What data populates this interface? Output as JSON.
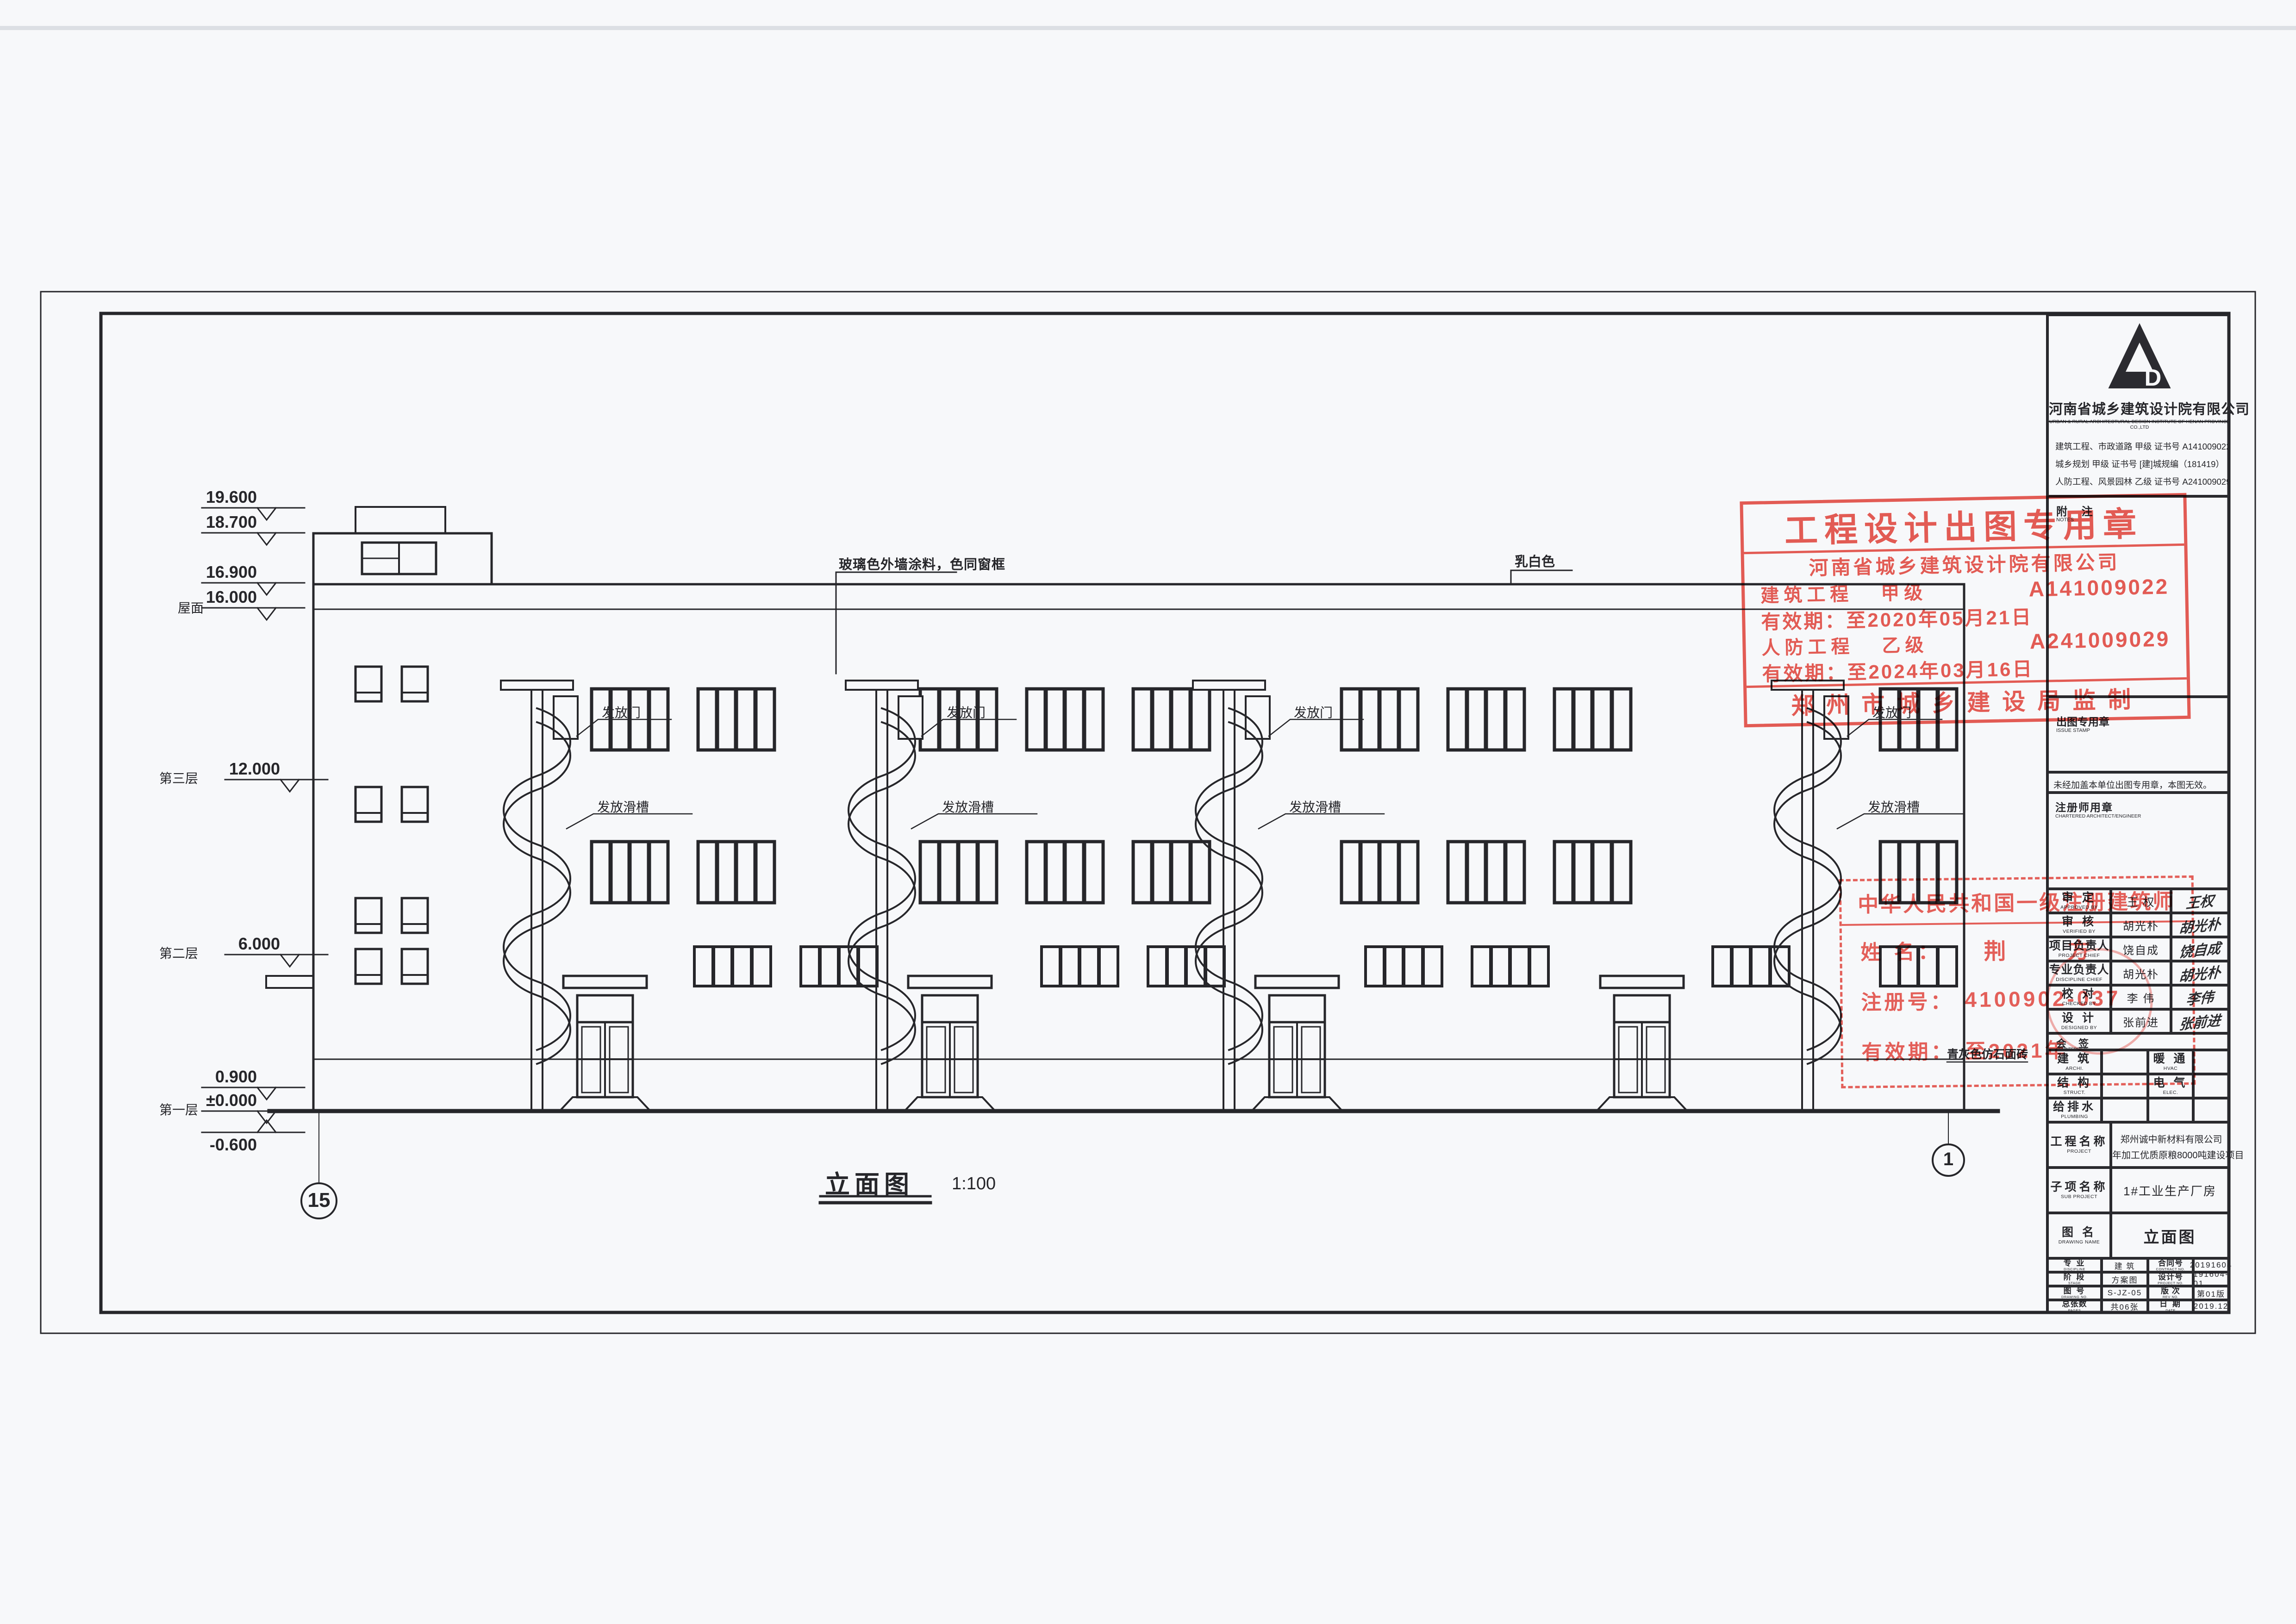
{
  "drawing": {
    "title": "立面图",
    "scale": "1:100",
    "annotations": {
      "wall_paint": "玻璃色外墙涂料，色同窗框",
      "parapet_color": "乳白色",
      "plinth": "青灰色仿石面砖",
      "chute_door": "发放门",
      "chute": "发放滑槽"
    },
    "elevations": [
      {
        "v": "19.600"
      },
      {
        "v": "18.700"
      },
      {
        "v": "16.900"
      },
      {
        "v": "16.000"
      },
      {
        "v": "12.000"
      },
      {
        "v": "6.000"
      },
      {
        "v": "0.900"
      },
      {
        "v": "±0.000"
      },
      {
        "v": "-0.600"
      }
    ],
    "floors": {
      "roof": "屋面",
      "f3": "第三层",
      "f2": "第二层",
      "f1": "第一层"
    },
    "axes": {
      "left": "15",
      "right": "1"
    }
  },
  "tb": {
    "company": {
      "name": "河南省城乡建筑设计院有限公司",
      "en": "URBAN & RURAL ARCHITECTURAL DESIGN INSTITUTE OF HENAN PROVINCE CO.,LTD",
      "cert1": "建筑工程、市政道路  甲级 证书号 A141009022",
      "cert2": "城乡规划  甲级  证书号 [建]城规编（181419）",
      "cert3": "人防工程、风景园林  乙级 证书号 A241009029",
      "logo_d": "D"
    },
    "notes": "附  注",
    "notes_en": "NOTES",
    "issue": "出图专用章",
    "issue_en": "ISSUE STAMP",
    "valid_note": "未经加盖本单位出图专用章，本图无效。",
    "chartered": "注册师用章",
    "chartered_en": "CHARTERED ARCHITECT/ENGINEER",
    "sig": [
      {
        "l": "审  定",
        "e": "APPROVED BY",
        "n": "王  权",
        "s": "王权"
      },
      {
        "l": "审  核",
        "e": "VERIFIED BY",
        "n": "胡光朴",
        "s": "胡光朴"
      },
      {
        "l": "项目负责人",
        "e": "PROJECT CHIEF",
        "n": "饶自成",
        "s": "饶自成"
      },
      {
        "l": "专业负责人",
        "e": "DISCIPLINE CHIEF",
        "n": "胡光朴",
        "s": "胡光朴"
      },
      {
        "l": "校  对",
        "e": "CHECKED BY",
        "n": "李  伟",
        "s": "李伟"
      },
      {
        "l": "设  计",
        "e": "DESIGNED BY",
        "n": "张前进",
        "s": "张前进"
      }
    ],
    "cs": {
      "l": "会  签",
      "e": "COUNTERSIGN"
    },
    "d1": {
      "l": "建  筑",
      "e": "ARCHI."
    },
    "d2": {
      "l": "暖  通",
      "e": "HVAC"
    },
    "d3": {
      "l": "结  构",
      "e": "STRUCT."
    },
    "d4": {
      "l": "电  气",
      "e": "ELEC."
    },
    "d5": {
      "l": "给排水",
      "e": "PLUMBING"
    },
    "proj": {
      "l": "工程名称",
      "e": "PROJECT",
      "v1": "郑州诚中新材料有限公司",
      "v2": "年加工优质原粮8000吨建设项目"
    },
    "sub": {
      "l": "子项名称",
      "e": "SUB PROJECT",
      "v": "1#工业生产厂房"
    },
    "dn": {
      "l": "图  名",
      "e": "DRAWING NAME",
      "v": "立面图"
    },
    "m1": {
      "l": "专  业",
      "e": "DISCIPLINE",
      "v": "建  筑",
      "l2": "合同号",
      "e2": "CONTRACT NO.",
      "v2": "20191604"
    },
    "m2": {
      "l": "阶  段",
      "e": "STAGE",
      "v": "方案图",
      "l2": "设计号",
      "e2": "PROJECT NO.",
      "v2": "191604-01"
    },
    "m3": {
      "l": "图  号",
      "e": "DRAWING NO.",
      "v": "S-JZ-05",
      "l2": "版  次",
      "e2": "REV NO.",
      "v2": "第01版"
    },
    "m4": {
      "l": "总张数",
      "e": "PAGES",
      "v": "共06张",
      "l2": "日  期",
      "e2": "DATE",
      "v2": "2019.12"
    }
  },
  "stamps": {
    "issue": {
      "title": "工程设计出图专用章",
      "company": "河南省城乡建筑设计院有限公司",
      "r1a": "建筑工程",
      "r1b": "甲级",
      "r1c": "A141009022",
      "r2": "有效期：至2020年05月21日",
      "r3a": "人防工程",
      "r3b": "乙级",
      "r3c": "A241009029",
      "r4": "有效期：至2024年03月16日",
      "footer": "郑州市城乡建设局监制"
    },
    "arch": {
      "title": "中华人民共和国一级注册建筑师",
      "nl": "姓  名：",
      "nv": "荆  方",
      "rl": "注册号：",
      "rv": "4100902-037",
      "vl": "有效期：",
      "vv": "至2021年"
    }
  },
  "colors": {
    "ink": "#26262a",
    "stamp_red": "#e8463e",
    "paper": "#f7f8fa"
  }
}
